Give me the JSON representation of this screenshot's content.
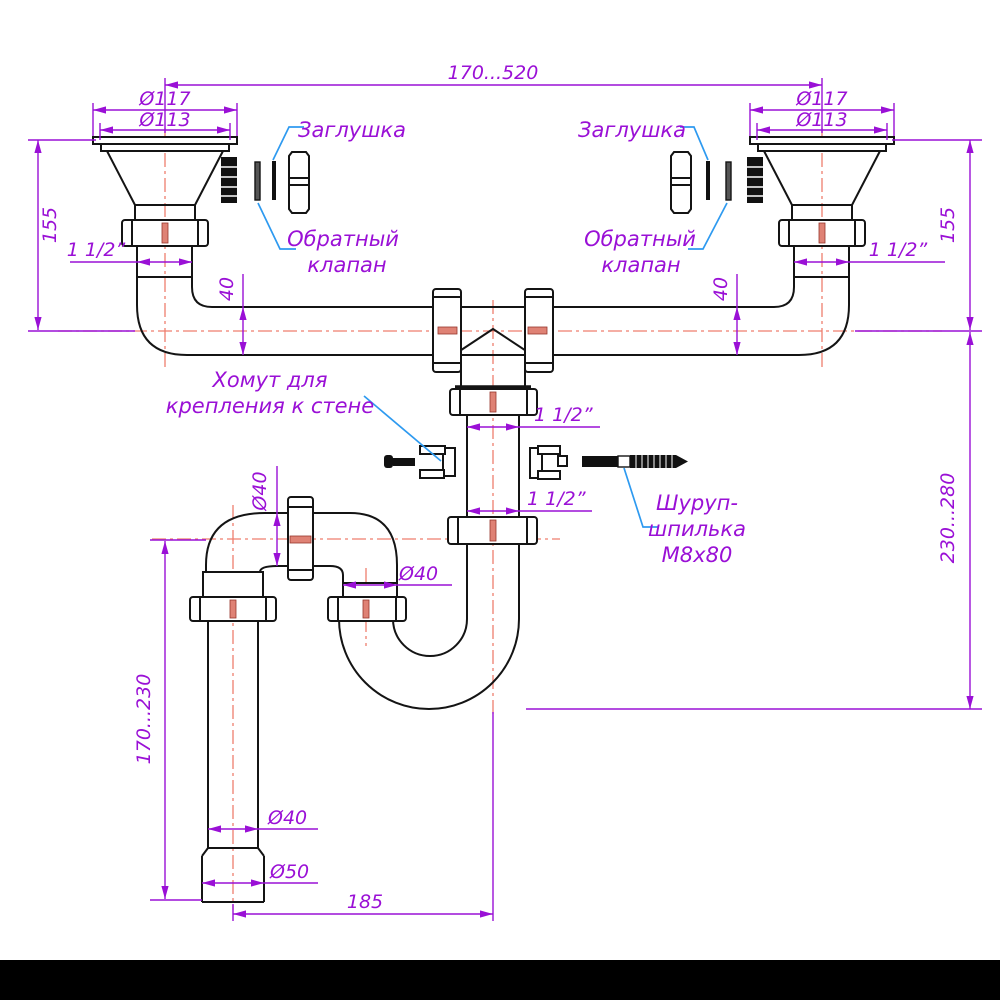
{
  "page": {
    "background": "#ffffff",
    "bottom_bar_color": "#000000"
  },
  "colors": {
    "dimension": "#9a10d6",
    "leader": "#2e9af0",
    "centerline": "#ef7e6e",
    "outline": "#141414"
  },
  "dims": {
    "top_span": "170...520",
    "flange_outer_left": "Ø117",
    "flange_inner_left": "Ø113",
    "flange_outer_right": "Ø117",
    "flange_inner_right": "Ø113",
    "height_left": "155",
    "height_right": "155",
    "thread_left": "1 1/2”",
    "thread_right": "1 1/2”",
    "pipe_dia_left": "40",
    "pipe_dia_right": "40",
    "tee_thread_upper": "1 1/2”",
    "tee_thread_lower": "1 1/2”",
    "elbow_dia": "Ø40",
    "arm_dia": "Ø40",
    "tail_dia": "Ø40",
    "outlet_dia": "Ø50",
    "trap_height": "230...280",
    "tail_height": "170...230",
    "bottom_offset": "185"
  },
  "labels": {
    "plug_left": "Заглушка",
    "plug_right": "Заглушка",
    "check_valve_left": [
      "Обратный",
      "клапан"
    ],
    "check_valve_right": [
      "Обратный",
      "клапан"
    ],
    "wall_clamp": [
      "Хомут для",
      "крепления к стене"
    ],
    "stud": [
      "Шуруп-",
      "шпилька",
      "М8х80"
    ]
  }
}
